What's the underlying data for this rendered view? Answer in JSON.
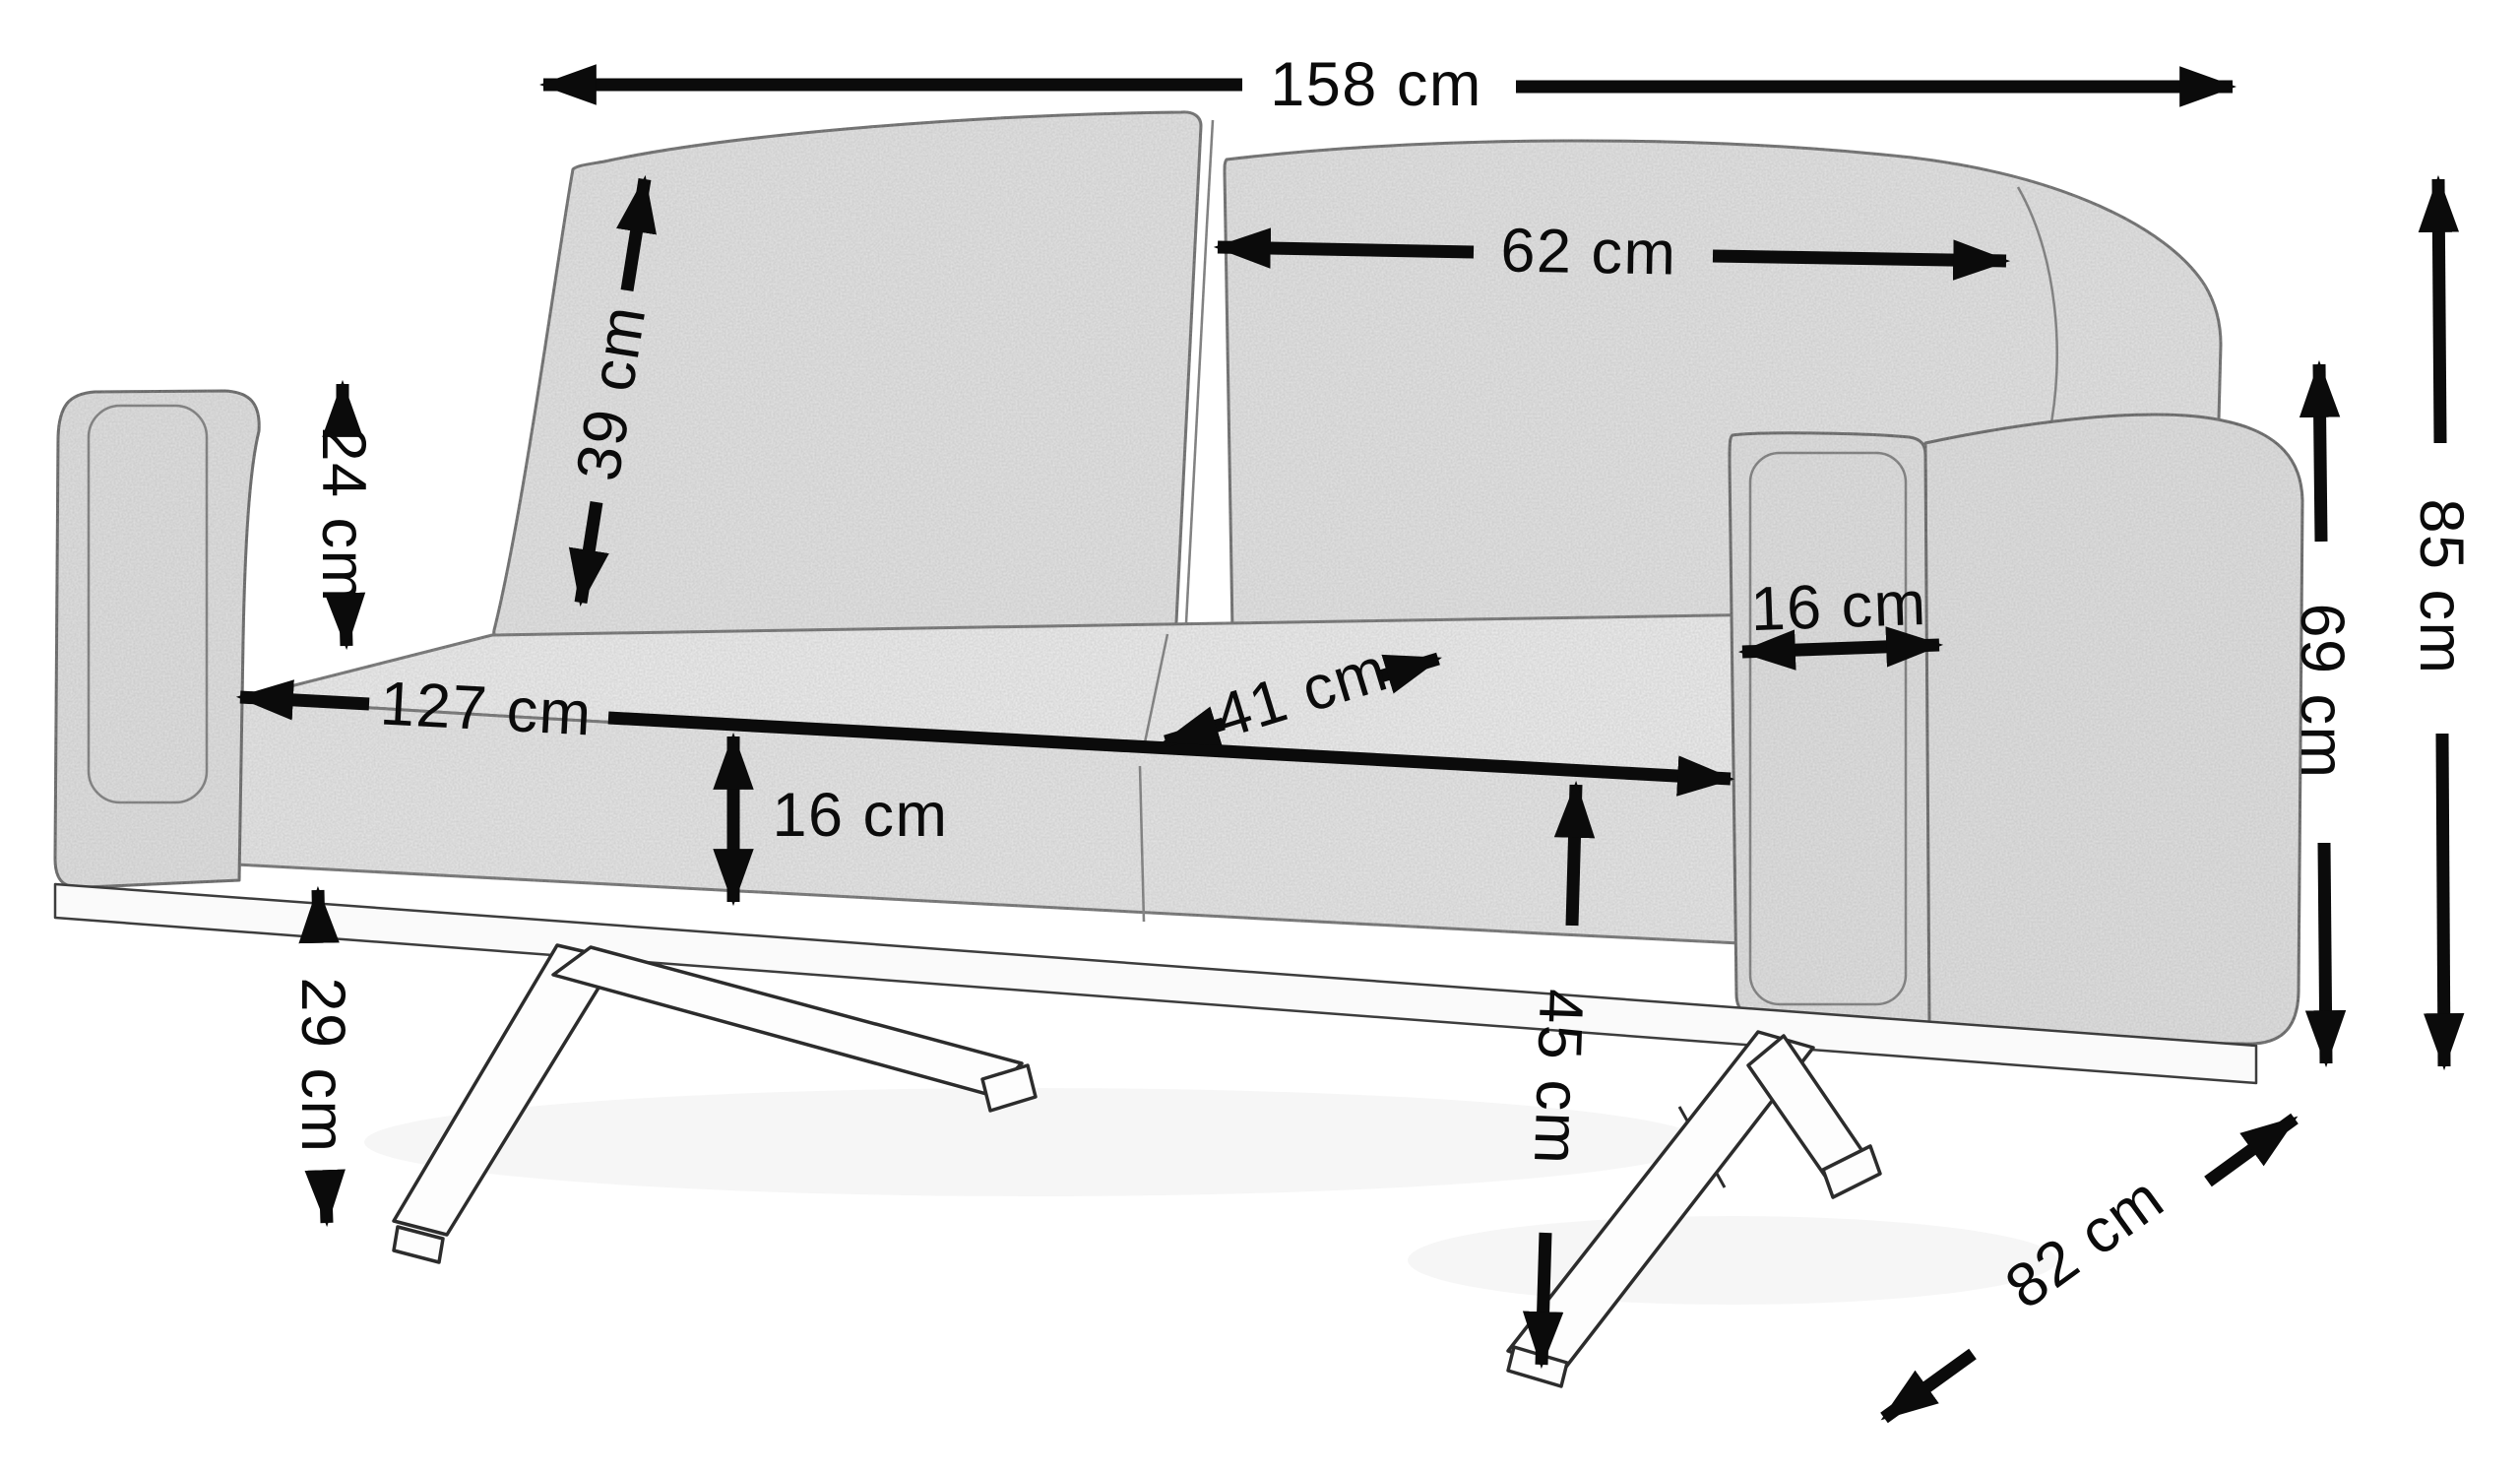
{
  "figure": {
    "title": "Sofa dimension diagram",
    "unit": "cm",
    "colors": {
      "background": "#ffffff",
      "dimension": "#0b0b0b",
      "fabric": "#e4e4e4",
      "outline": "#5c5c5c",
      "leg_fill": "#fdfdfd",
      "leg_outline": "#2c2c2c"
    },
    "measurements": {
      "total_width": "158 cm",
      "backrest_cushion_width": "62 cm",
      "backrest_cushion_height": "39 cm",
      "armrest_height_above_seat": "24 cm",
      "seat_width": "127 cm",
      "seat_depth": "41 cm",
      "seat_cushion_thickness": "16 cm",
      "armrest_width": "16 cm",
      "underframe_clearance": "29 cm",
      "seat_height": "45 cm",
      "armrest_height": "69 cm",
      "total_height": "85 cm",
      "total_depth": "82 cm"
    }
  }
}
